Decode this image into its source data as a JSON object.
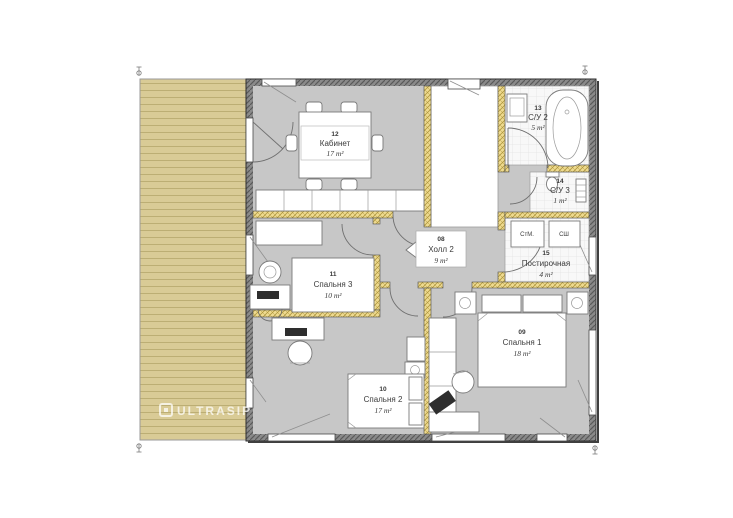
{
  "brand": {
    "watermark": "ULTRASIP"
  },
  "rooms": [
    {
      "id": "08",
      "name": "Холл 2",
      "area": "9 m²"
    },
    {
      "id": "09",
      "name": "Спальня 1",
      "area": "18 m²"
    },
    {
      "id": "10",
      "name": "Спальня 2",
      "area": "17 m²"
    },
    {
      "id": "11",
      "name": "Спальня 3",
      "area": "10 m²"
    },
    {
      "id": "12",
      "name": "Кабинет",
      "area": "17 m²"
    },
    {
      "id": "13",
      "name": "С/У 2",
      "area": "5 m²"
    },
    {
      "id": "14",
      "name": "С/У 3",
      "area": "1 m²"
    },
    {
      "id": "15",
      "name": "Постирочная",
      "area": "4 m²"
    }
  ],
  "appliances": [
    {
      "label": "СтМ."
    },
    {
      "label": "СШ"
    }
  ],
  "palette": {
    "terrace": "#d9cb96",
    "floor": "#c7c7c7",
    "wall_hatch": "#8a8a8a",
    "insulation": "#eeda8f",
    "tile": "#f8f8f8"
  }
}
